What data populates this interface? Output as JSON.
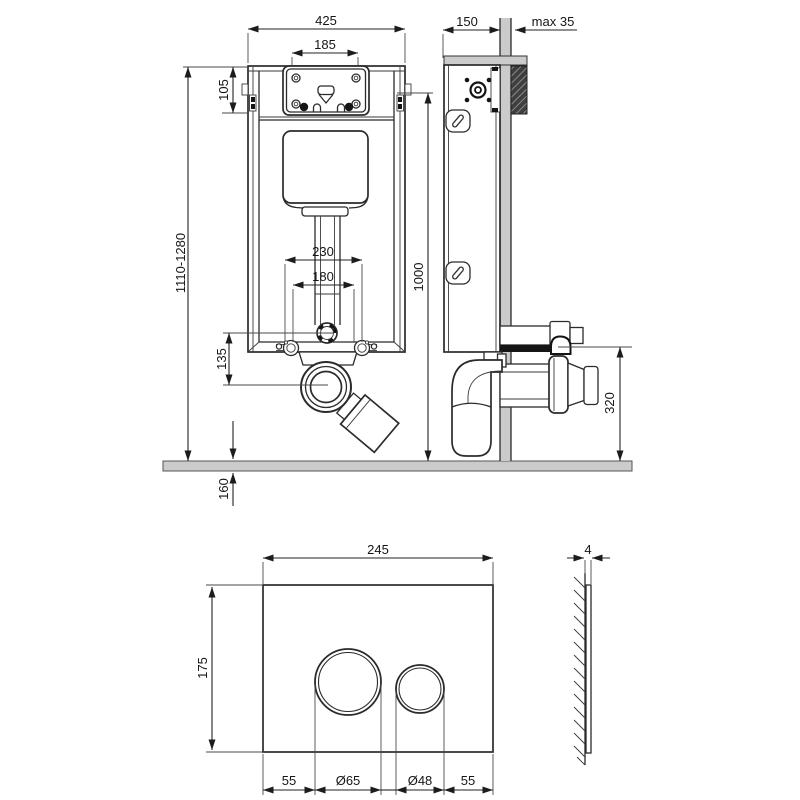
{
  "dims": {
    "frame_width": "425",
    "access_opening_width": "185",
    "access_opening_height": "105",
    "installation_height_range": "1110-1280",
    "bolt_spacing_outer": "230",
    "bolt_spacing_inner": "180",
    "drain_offset": "135",
    "floor_buildup": "160",
    "frame_height": "1000",
    "frame_depth": "150",
    "wall_finish_max": "max 35",
    "drain_outlet_height": "320",
    "plate_width": "245",
    "plate_height": "175",
    "plate_margin_left": "55",
    "button_large_dia": "Ø65",
    "button_small_dia": "Ø48",
    "plate_margin_right": "55",
    "plate_thickness": "4"
  },
  "colors": {
    "line": "#2b2b2b",
    "floor_fill": "#cbcbcb",
    "wall_fill": "#cbcbcb",
    "hatch_dark": "#3f3f3f"
  }
}
